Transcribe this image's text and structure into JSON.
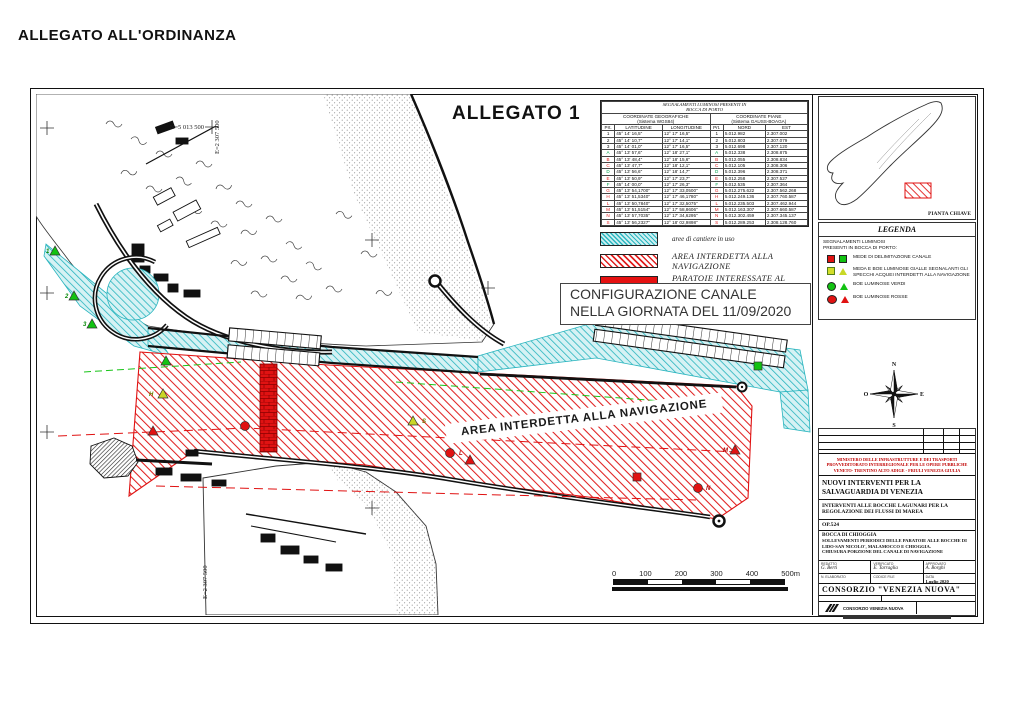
{
  "page": {
    "title": "ALLEGATO ALL'ORDINANZA"
  },
  "drawing": {
    "sheet_title": "ALLEGATO 1",
    "config_box": {
      "line1": "CONFIGURAZIONE CANALE",
      "line2": "NELLA GIORNATA DEL 11/09/2020"
    },
    "area_label": "AREA INTERDETTA ALLA NAVIGAZIONE",
    "grid": {
      "north": "N=5 013 500",
      "east": "E=2 307 500"
    },
    "scale": {
      "ticks": [
        "0",
        "100",
        "200",
        "300",
        "400",
        "500m"
      ]
    },
    "compass": {
      "n": "N",
      "e": "E",
      "s": "S",
      "o": "O"
    }
  },
  "signals_table": {
    "title": [
      "SEGNALAMENTI LUMINOSI PRESENTI IN",
      "BOCCA DI PORTO"
    ],
    "groups": [
      {
        "l1": "COORDINATE GEOGRAFICHE",
        "l2": "(Sistema WGS84)"
      },
      {
        "l1": "COORDINATE PIANE",
        "l2": "(Sistema GAUSS-BOAGA)"
      }
    ],
    "cols": [
      "Prt.",
      "LATITUDINE",
      "LONGITUDINE",
      "Prt.",
      "NORD",
      "EST"
    ],
    "rows": [
      {
        "id": "1",
        "color": "#111111",
        "lat": "45° 14' 16,5\"",
        "lon": "12° 17' 16,5\"",
        "nord": "5.012.982",
        "est": "2.307.002"
      },
      {
        "id": "2",
        "color": "#111111",
        "lat": "45° 14' 10,7\"",
        "lon": "12° 17' 14,1\"",
        "nord": "5.012.803",
        "est": "2.307.079"
      },
      {
        "id": "3",
        "color": "#111111",
        "lat": "45° 14' 01,0\"",
        "lon": "12° 17' 16,5\"",
        "nord": "5.012.698",
        "est": "2.307.120"
      },
      {
        "id": "A",
        "color": "#00a14b",
        "lat": "45° 13' 57,6\"",
        "lon": "12° 18' 27,1\"",
        "nord": "5.012.338",
        "est": "2.308.875"
      },
      {
        "id": "B",
        "color": "#e02020",
        "lat": "45° 13' 48,4\"",
        "lon": "12° 18' 15,6\"",
        "nord": "5.012.055",
        "est": "2.308.834"
      },
      {
        "id": "C",
        "color": "#e02020",
        "lat": "45° 13' 47,7\"",
        "lon": "12° 18' 12,1\"",
        "nord": "5.012.105",
        "est": "2.308.306"
      },
      {
        "id": "D",
        "color": "#00a14b",
        "lat": "45° 13' 56,6\"",
        "lon": "12° 18' 14,7\"",
        "nord": "5.012.396",
        "est": "2.308.371"
      },
      {
        "id": "E",
        "color": "#e02020",
        "lat": "45° 13' 50,9\"",
        "lon": "12° 17' 23,7\"",
        "nord": "5.012.258",
        "est": "2.307.527"
      },
      {
        "id": "F",
        "color": "#00a14b",
        "lat": "45° 14' 00,0\"",
        "lon": "12° 17' 26,3\"",
        "nord": "5.012.535",
        "est": "2.307.364"
      },
      {
        "id": "G",
        "color": "#e02020",
        "lat": "45° 13' 54,1700\"",
        "lon": "12° 17' 33,0500\"",
        "nord": "5.012.275.622",
        "est": "2.307.562.268"
      },
      {
        "id": "H",
        "color": "#e02020",
        "lat": "45° 13' 51,5340\"",
        "lon": "12° 17' 46,1780\"",
        "nord": "5.012.249.136",
        "est": "2.307.760.587"
      },
      {
        "id": "L",
        "color": "#e02020",
        "lat": "45° 13' 50,7840\"",
        "lon": "12° 17' 32,5075\"",
        "nord": "5.012.235.503",
        "est": "2.307.462.944"
      },
      {
        "id": "M",
        "color": "#e02020",
        "lat": "45° 13' 51,5154\"",
        "lon": "12° 17' 58,8606\"",
        "nord": "5.012.163.307",
        "est": "2.307.660.587"
      },
      {
        "id": "N",
        "color": "#e02020",
        "lat": "45° 13' 57,7035\"",
        "lon": "12° 17' 34,6295\"",
        "nord": "5.012.302.459",
        "est": "2.307.345.137"
      },
      {
        "id": "S",
        "color": "#e02020",
        "lat": "45° 13' 56,2327\"",
        "lon": "12° 18' 02,9898\"",
        "nord": "5.012.289.253",
        "est": "2.308.128.760"
      }
    ]
  },
  "map_legend": {
    "items": [
      {
        "sw": "cyan-hatch",
        "cls": "lbl-sm",
        "label": "aree di cantiere in uso"
      },
      {
        "sw": "red-hatch",
        "cls": "lbl-lg",
        "label": "AREA INTERDETTA ALLA NAVIGAZIONE"
      },
      {
        "sw": "red-solid",
        "cls": "lbl-lg",
        "label": "PARATOIE INTERESSATE AL SOLLEVAMENTO"
      }
    ]
  },
  "legenda": {
    "title": "LEGENDA",
    "sub1": "SEGNALAMENTI LUMINOSI",
    "sub2": "PRESENTI IN BOCCA DI PORTO:",
    "items": [
      {
        "icon1": "red-square",
        "icon2": "green-square",
        "label": "MEDE DI DELIMITAZIONE CANALE"
      },
      {
        "icon1": "yellow-square",
        "icon2": "yellow-triangle",
        "label": "MEDA E BOE LUMINOSE GIALLE SEGNALANTI GLI SPECCHI ACQUEI INTERDETTI ALLA NAVIGAZIONE"
      },
      {
        "icon1": "green-circle",
        "icon2": "green-triangle",
        "label": "BOE LUMINOSE VERDI"
      },
      {
        "icon1": "red-circle",
        "icon2": "red-triangle",
        "label": "BOE LUMINOSE ROSSE"
      }
    ]
  },
  "key_map": {
    "label": "PIANTA CHIAVE"
  },
  "title_block": {
    "ministry_lines": [
      "MINISTERO DELLE INFRASTRUTTURE E DEI TRASPORTI",
      "PROVVEDITORATO INTERREGIONALE PER LE OPERE PUBBLICHE",
      "VENETO- TRENTINO ALTO ADIGE - FRIULI VENEZIA GIULIA"
    ],
    "project_title": "NUOVI INTERVENTI PER LA SALVAGUARDIA DI VENEZIA",
    "project_subtitle": "INTERVENTI ALLE BOCCHE LAGUNARI PER LA REGOLAZIONE DEI FLUSSI DI MAREA",
    "op_code": "OP.524",
    "location": "BOCCA DI CHIOGGIA",
    "subject": "SOLLEVAMENTI PERIODICI DELLE PARATOIE ALLE BOCCHE DI LIDO-SAN NICOLO', MALAMOCCO E CHIOGGIA.",
    "subject2": "CHIUSURA PORZIONE DEL CANALE DI NAVIGAZIONE",
    "signatures": [
      {
        "role": "REDATTO",
        "name": "G. Berti"
      },
      {
        "role": "VERIFICATO",
        "name": "E. Tarraglia"
      },
      {
        "role": "APPROVATO",
        "name": "A. Borghi"
      }
    ],
    "meta": {
      "n_elaborato": "N. ELABORATO",
      "codice": "CODICE FILE",
      "data_label": "DATA",
      "data_value": "Luglio 2020"
    },
    "consortium": "CONSORZIO  \"VENEZIA NUOVA\"",
    "logo_text": "CONSORZIO VENEZIA NUOVA"
  },
  "map": {
    "marker_colors": {
      "green": "#12c212",
      "red": "#e01212",
      "yellow": "#c9d626"
    },
    "label_colors": {
      "green": "#0a8a0a",
      "red": "#b00000",
      "yellow": "#6a7a00"
    },
    "markers": [
      {
        "t": "tri",
        "c": "green",
        "x": 19,
        "y": 157,
        "label": "1",
        "lx": 10,
        "ly": 159
      },
      {
        "t": "tri",
        "c": "green",
        "x": 38,
        "y": 202,
        "label": "2",
        "lx": 29,
        "ly": 204
      },
      {
        "t": "tri",
        "c": "green",
        "x": 56,
        "y": 230,
        "label": "3",
        "lx": 47,
        "ly": 232
      },
      {
        "t": "tri",
        "c": "green",
        "x": 130,
        "y": 267
      },
      {
        "t": "tri",
        "c": "yellow",
        "x": 127,
        "y": 300,
        "label": "H",
        "lx": 113,
        "ly": 302
      },
      {
        "t": "tri",
        "c": "red",
        "x": 117,
        "y": 337
      },
      {
        "t": "circ",
        "c": "red",
        "x": 209,
        "y": 332
      },
      {
        "t": "tri",
        "c": "yellow",
        "x": 377,
        "y": 327,
        "label": "S",
        "lx": 386,
        "ly": 329
      },
      {
        "t": "circ",
        "c": "red",
        "x": 414,
        "y": 359,
        "label": "L",
        "lx": 423,
        "ly": 361
      },
      {
        "t": "circ",
        "c": "red",
        "x": 507,
        "y": 334,
        "label": "G",
        "lx": 516,
        "ly": 336
      },
      {
        "t": "tri",
        "c": "red",
        "x": 434,
        "y": 366
      },
      {
        "t": "sq",
        "c": "red",
        "x": 601,
        "y": 383
      },
      {
        "t": "sq",
        "c": "green",
        "x": 614,
        "y": 316
      },
      {
        "t": "sq",
        "c": "green",
        "x": 722,
        "y": 272
      },
      {
        "t": "tri",
        "c": "red",
        "x": 699,
        "y": 356,
        "label": "M",
        "lx": 687,
        "ly": 358
      },
      {
        "t": "circ",
        "c": "red",
        "x": 662,
        "y": 394,
        "label": "N",
        "lx": 670,
        "ly": 396
      }
    ]
  }
}
